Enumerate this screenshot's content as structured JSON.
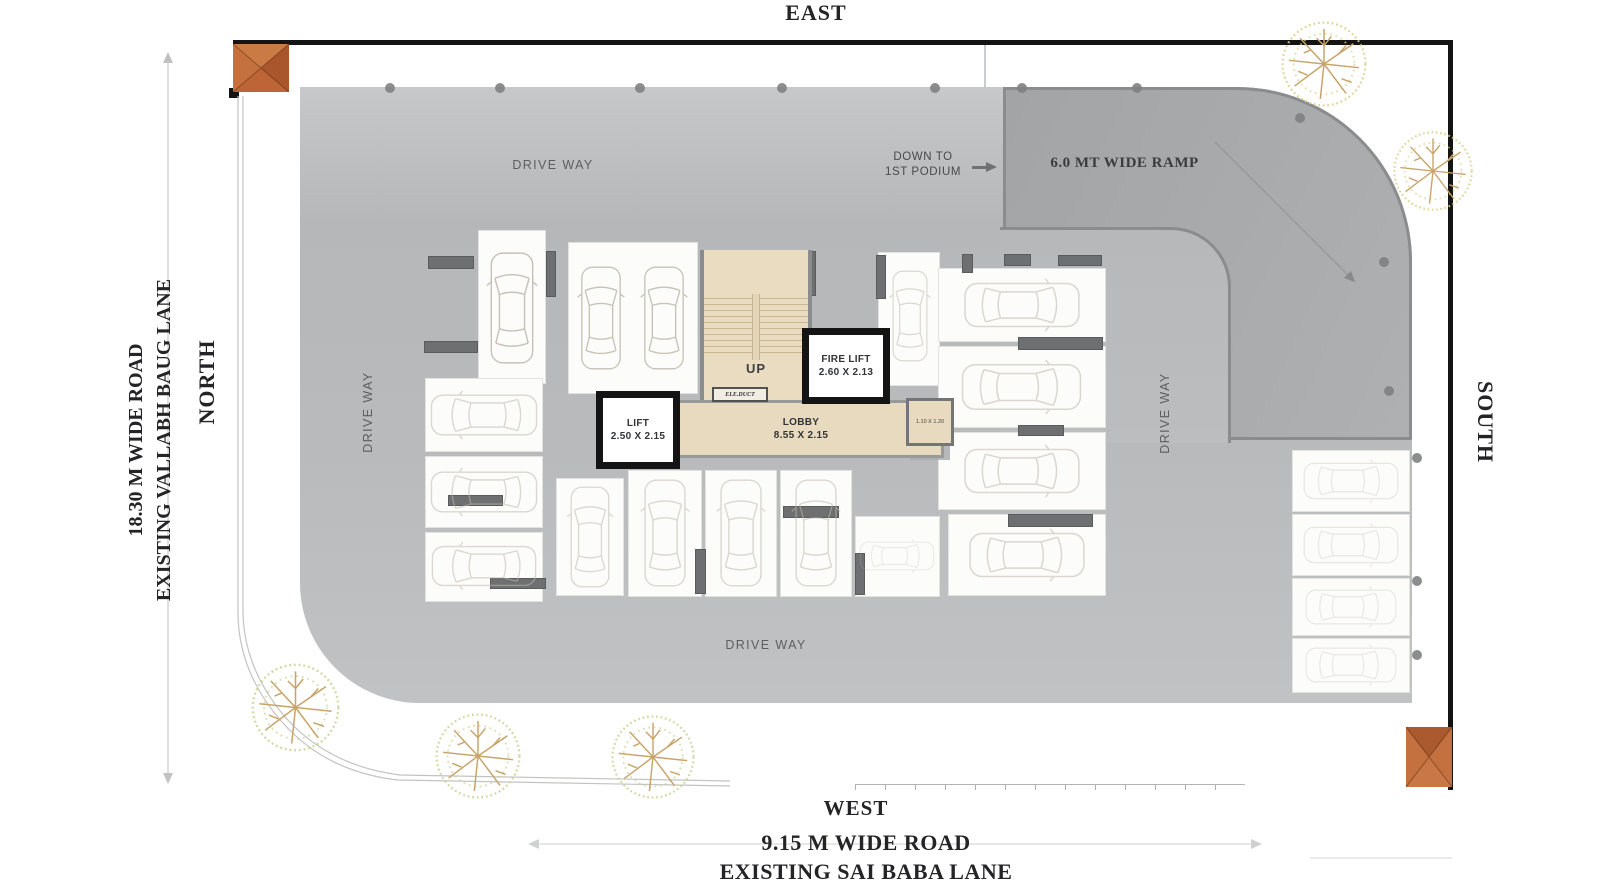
{
  "compass": {
    "east": "EAST",
    "west": "WEST",
    "north": "NORTH",
    "south": "SOUTH"
  },
  "left_road": {
    "line1": "18.30 M WIDE  ROAD",
    "line2": "EXISTING  VALLABH  BAUG LANE"
  },
  "bottom_road": {
    "line1": "9.15 M WIDE  ROAD",
    "line2": "EXISTING SAI BABA LANE"
  },
  "ramp": {
    "label": "6.0 MT WIDE RAMP",
    "down_line1": "DOWN  TO",
    "down_line2": "1ST PODIUM"
  },
  "driveways": {
    "top": "DRIVE WAY",
    "left": "DRIVE WAY",
    "right": "DRIVE WAY",
    "bottom": "DRIVE WAY"
  },
  "core": {
    "up": "UP",
    "ele_duct": "ELE.DUCT",
    "lift_name": "LIFT",
    "lift_size": "2.50 X 2.15",
    "fire_lift_name": "FIRE LIFT",
    "fire_lift_size": "2.60 X 2.13",
    "lobby_name": "LOBBY",
    "lobby_size": "8.55 X 2.15",
    "duct_size": "1.10 X 1.20"
  },
  "colors": {
    "podium": "#b9bbbd",
    "ramp": "#a7a9ab",
    "core_floor": "#e8dabe",
    "wall": "#141414",
    "gate": "#c06a3c",
    "bar": "#6d6f71"
  }
}
